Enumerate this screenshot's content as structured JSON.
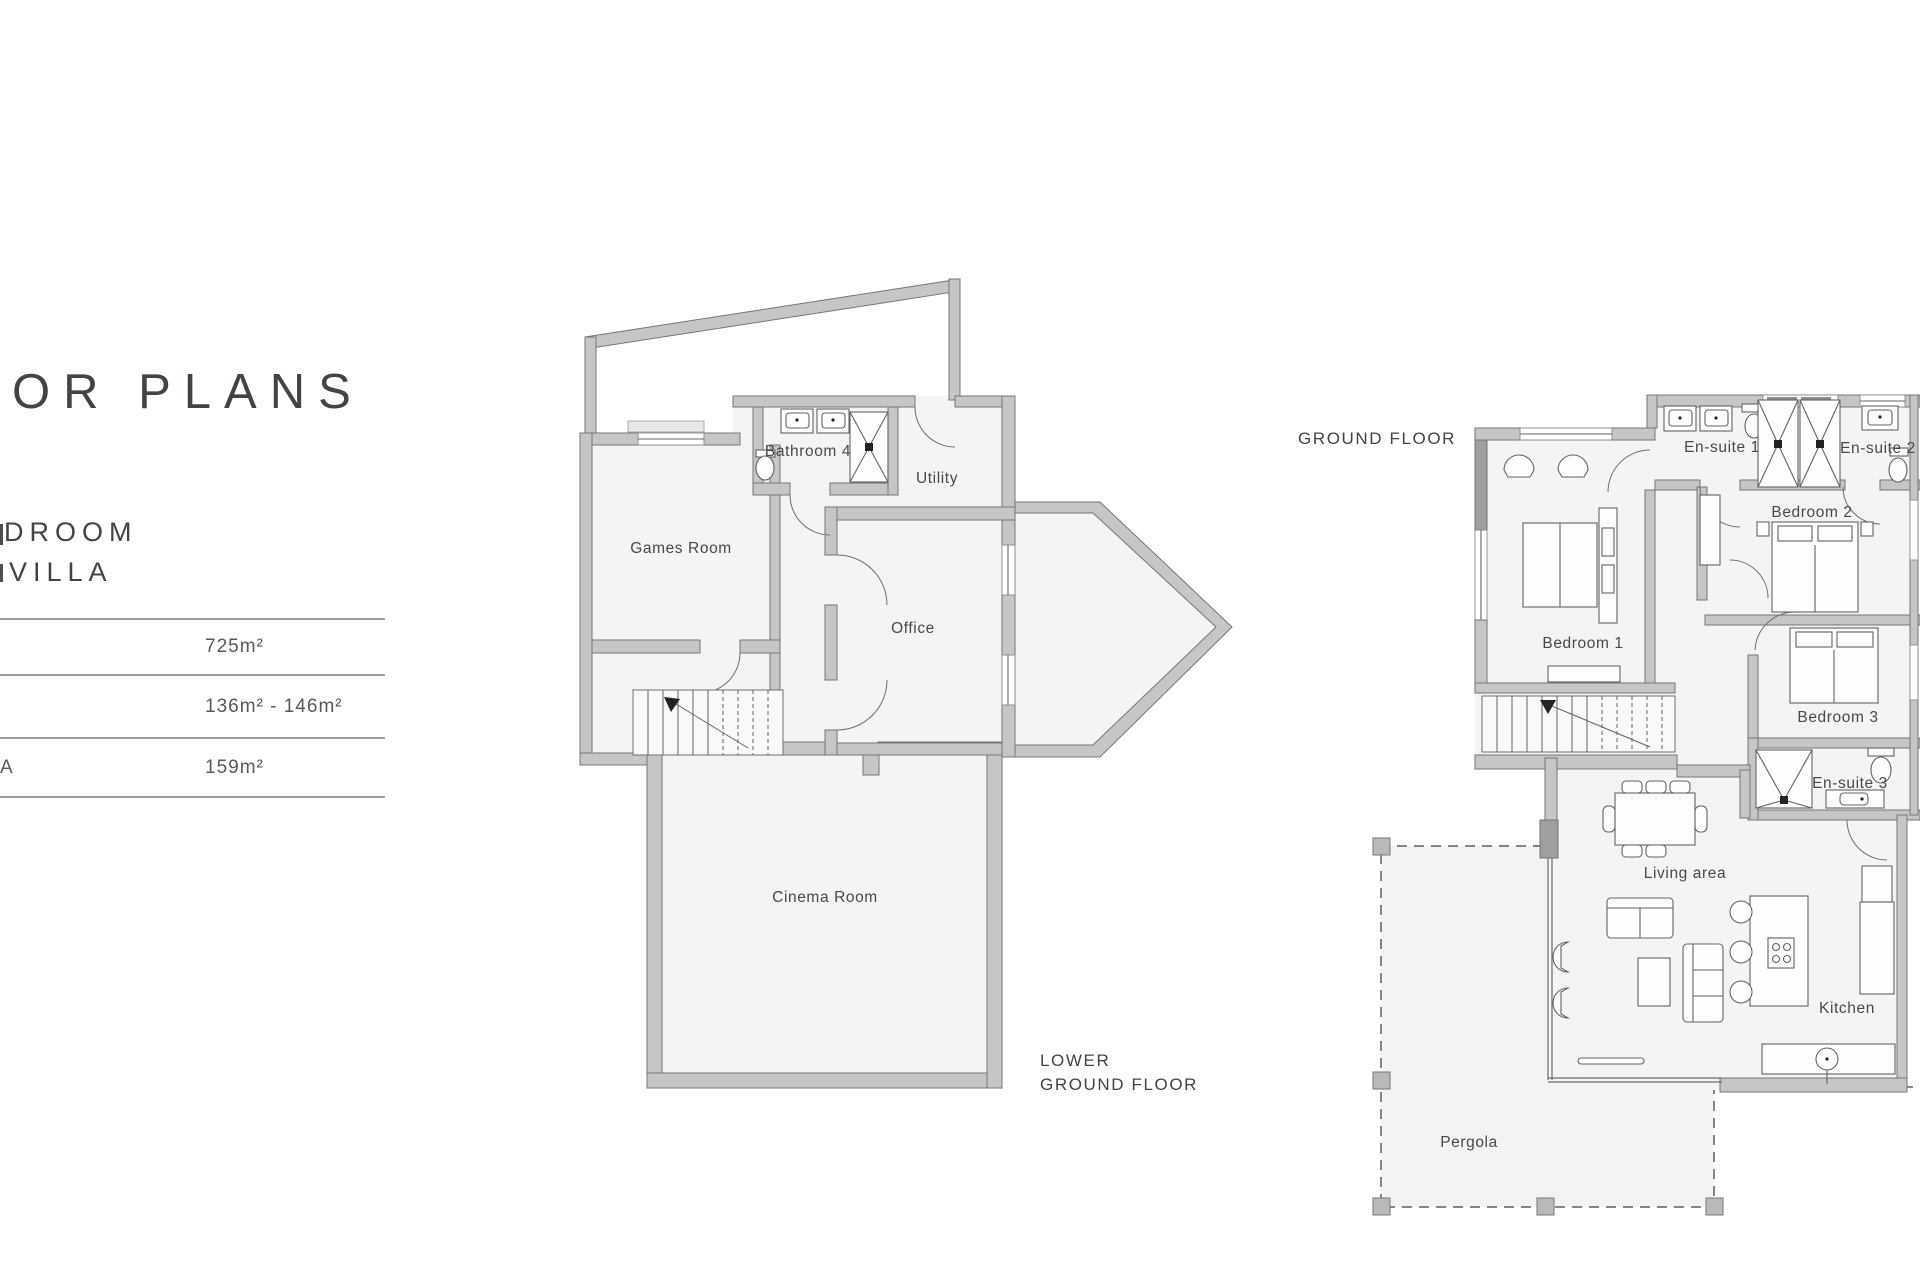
{
  "header": {
    "title_visible": "OR PLANS",
    "subtitle_line1": "DROOM",
    "subtitle_line2": "VILLA"
  },
  "spec_table": {
    "rows": [
      {
        "label": "",
        "value": "725m²"
      },
      {
        "label": "",
        "value": "136m² - 146m²"
      },
      {
        "label": "A",
        "value": "159m²"
      }
    ]
  },
  "plans": {
    "lower_ground": {
      "title_line1": "LOWER",
      "title_line2": "GROUND FLOOR",
      "rooms": {
        "bathroom4": "Bathroom 4",
        "utility": "Utility",
        "games_room": "Games Room",
        "office": "Office",
        "cinema_room": "Cinema Room"
      }
    },
    "ground": {
      "title": "GROUND FLOOR",
      "rooms": {
        "ensuite1": "En-suite 1",
        "ensuite2": "En-suite 2",
        "bedroom2": "Bedroom 2",
        "bedroom1": "Bedroom 1",
        "bedroom3": "Bedroom 3",
        "ensuite3": "En-suite 3",
        "living_area": "Living area",
        "kitchen": "Kitchen",
        "pergola": "Pergola"
      }
    }
  },
  "colors": {
    "wall_fill": "#c6c6c6",
    "wall_outline": "#757575",
    "room_fill": "#f4f4f4",
    "terrace_fill": "#ffffff",
    "pergola_fill": "#f3f3f3",
    "label_text": "#44494c",
    "heading_text": "#3f4449",
    "rule": "#9a9ea1"
  }
}
